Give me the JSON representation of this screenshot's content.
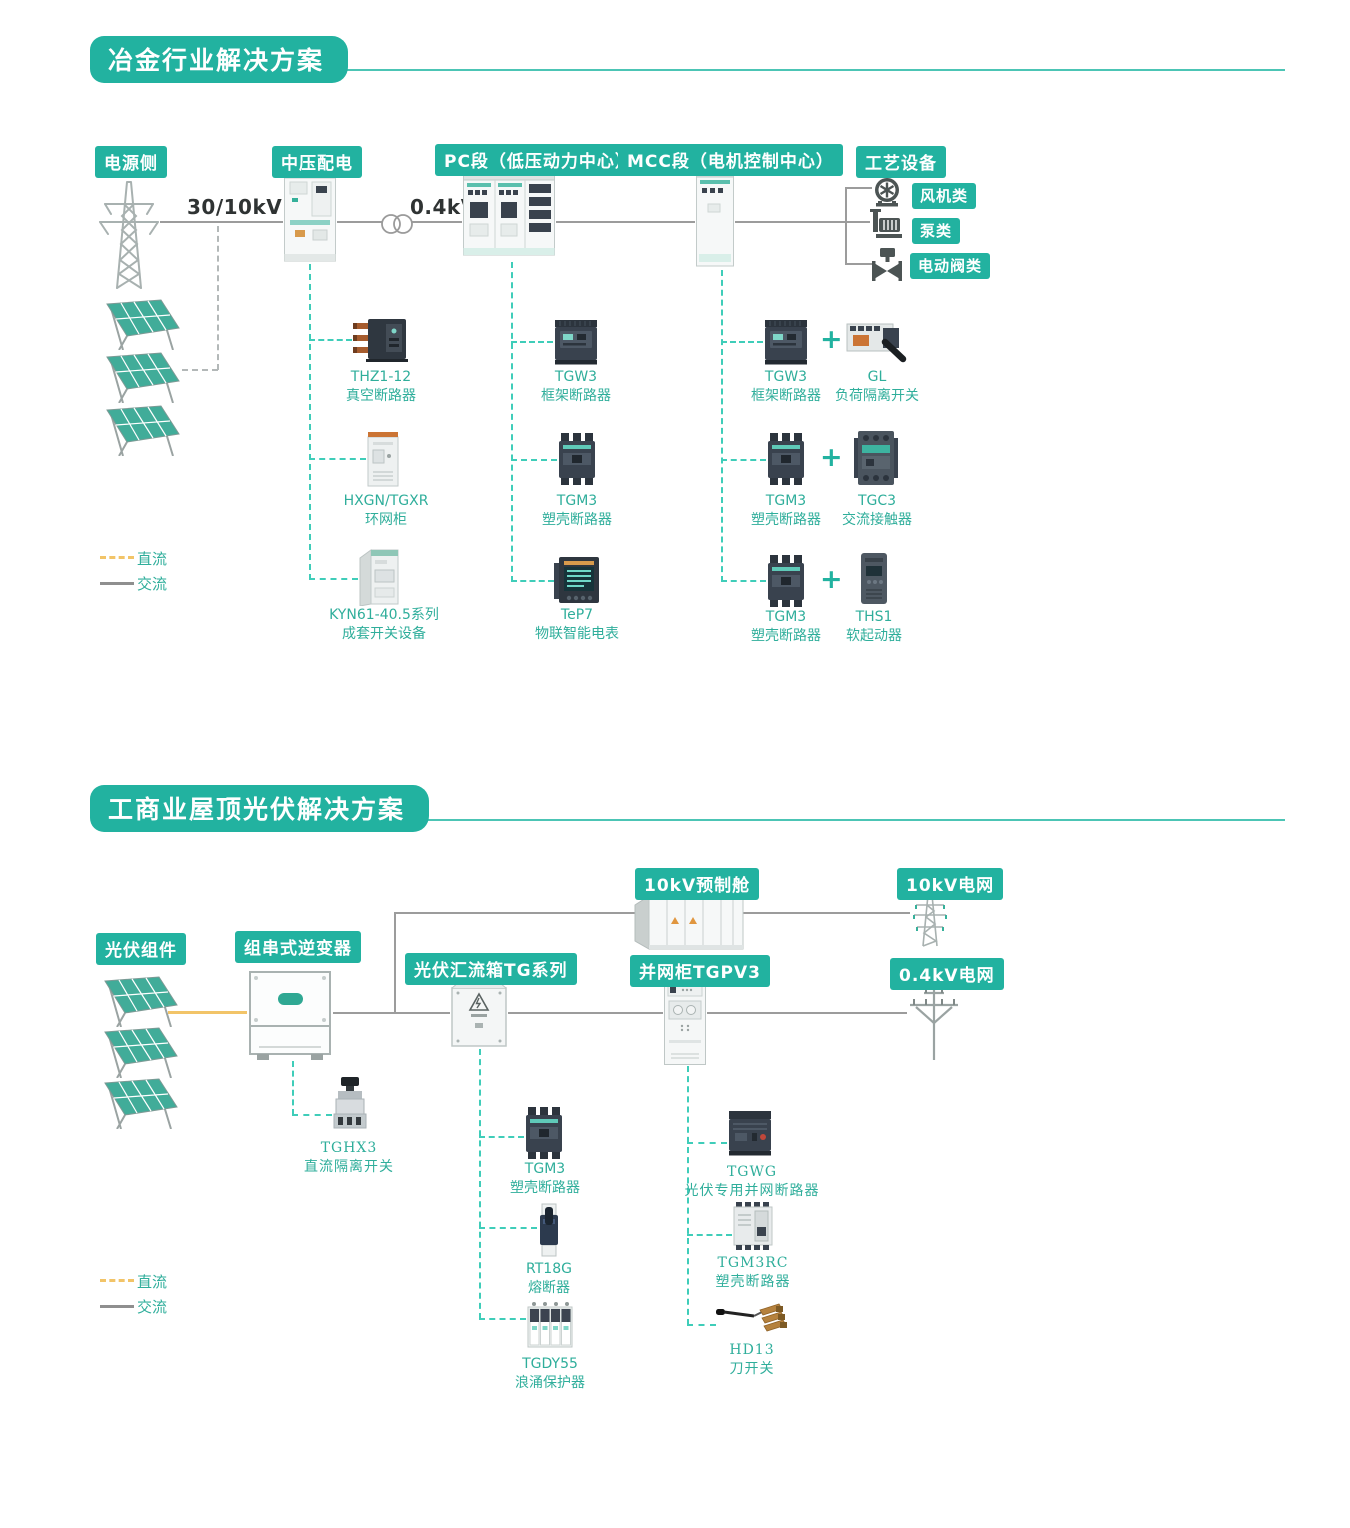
{
  "colors": {
    "teal": "#22b2a0",
    "connector_dash_teal": "#3fcdb9",
    "dc_yellow": "#f2c468",
    "ac_gray": "#9c9c9c"
  },
  "s1": {
    "title": "冶金行业解决方案",
    "stage_power": "电源侧",
    "stage_mv": "中压配电",
    "stage_pc": "PC段（低压动力中心）",
    "stage_mcc": "MCC段（电机控制中心）",
    "stage_process": "工艺设备",
    "voltage_in": "30/10kV",
    "voltage_lv": "0.4kV",
    "process_items": [
      "风机类",
      "泵类",
      "电动阀类"
    ],
    "mv_products": [
      {
        "model": "THZ1-12",
        "name": "真空断路器"
      },
      {
        "model": "HXGN/TGXR",
        "name": "环网柜"
      },
      {
        "model": "KYN61-40.5系列",
        "name": "成套开关设备"
      }
    ],
    "pc_products": [
      {
        "model": "TGW3",
        "name": "框架断路器"
      },
      {
        "model": "TGM3",
        "name": "塑壳断路器"
      },
      {
        "model": "TeP7",
        "name": "物联智能电表"
      }
    ],
    "mcc_rows": [
      {
        "a": {
          "model": "TGW3",
          "name": "框架断路器"
        },
        "plus": "+",
        "b": {
          "model": "GL",
          "name": "负荷隔离开关"
        }
      },
      {
        "a": {
          "model": "TGM3",
          "name": "塑壳断路器"
        },
        "plus": "+",
        "b": {
          "model": "TGC3",
          "name": "交流接触器"
        }
      },
      {
        "a": {
          "model": "TGM3",
          "name": "塑壳断路器"
        },
        "plus": "+",
        "b": {
          "model": "THS1",
          "name": "软起动器"
        }
      }
    ],
    "legend": {
      "dc": "直流",
      "ac": "交流"
    }
  },
  "s2": {
    "title": "工商业屋顶光伏解决方案",
    "stage_pv": "光伏组件",
    "stage_inverter": "组串式逆变器",
    "stage_combiner": "光伏汇流箱TG系列",
    "stage_grid_cabinet": "并网柜TGPV3",
    "stage_prefab": "10kV预制舱",
    "stage_grid10": "10kV电网",
    "stage_grid04": "0.4kV电网",
    "inverter_product": {
      "model": "TGHX3",
      "name": "直流隔离开关"
    },
    "combiner_products": [
      {
        "model": "TGM3",
        "name": "塑壳断路器"
      },
      {
        "model": "RT18G",
        "name": "熔断器"
      },
      {
        "model": "TGDY55",
        "name": "浪涌保护器"
      }
    ],
    "grid_products": [
      {
        "model": "TGWG",
        "name": "光伏专用并网断路器"
      },
      {
        "model": "TGM3RC",
        "name": "塑壳断路器"
      },
      {
        "model": "HD13",
        "name": "刀开关"
      }
    ],
    "legend": {
      "dc": "直流",
      "ac": "交流"
    }
  }
}
